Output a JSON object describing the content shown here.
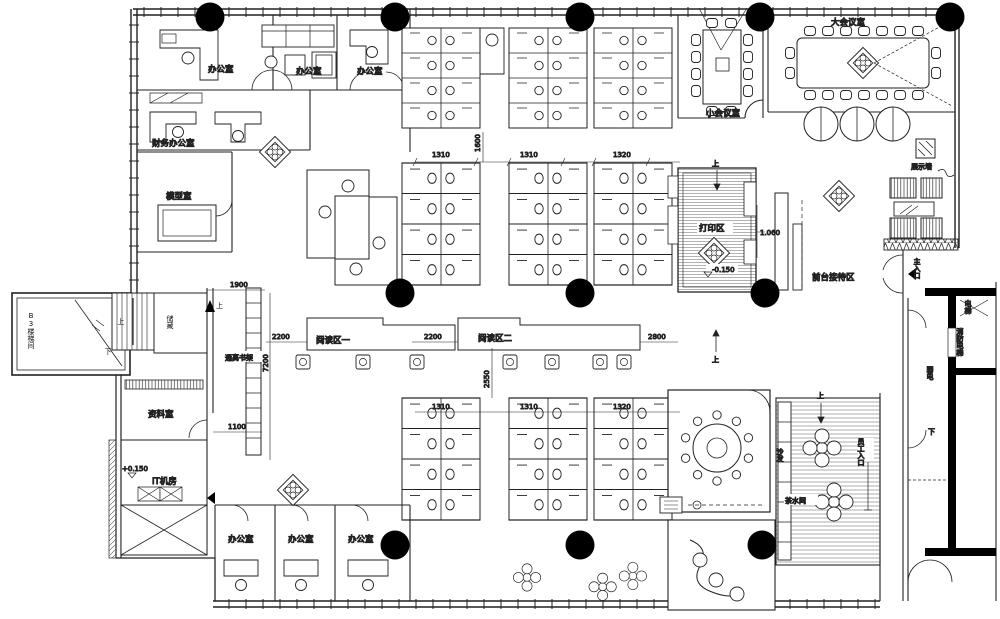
{
  "plan": {
    "rooms": {
      "office": "办公室",
      "finance_office": "财务办公室",
      "model_room": "模型室",
      "small_meeting_room": "小会议室",
      "large_meeting_room": "大会议室",
      "display_wall": "展示墙",
      "reception_area": "前台接待区",
      "print_area": "打印区",
      "reading_area_1": "阅读区一",
      "reading_area_2": "阅读区二",
      "tall_bookshelf": "通高书架",
      "archive_room": "资料室",
      "it_room": "IT机房",
      "b3_stairwell": "B3楼梯间",
      "storage": "储藏",
      "tea_room": "茶水间",
      "sofa": "沙发"
    },
    "circulation": {
      "main_entrance": "主入口",
      "staff_entrance": "员工入口",
      "elevator": "电梯",
      "fire_elevator": "消防电梯",
      "weak_power": "弱电",
      "up": "上",
      "down": "下"
    },
    "dimensions": {
      "d1310": "1310",
      "d1320": "1320",
      "d1600": "1600",
      "d2200": "2200",
      "d2800": "2800",
      "d2550": "2550",
      "d7200": "7200",
      "d1900": "1900",
      "d1100": "1100",
      "d1060": "1.060"
    },
    "elevations": {
      "neg": "-0.150",
      "pos": "+0.150"
    }
  }
}
